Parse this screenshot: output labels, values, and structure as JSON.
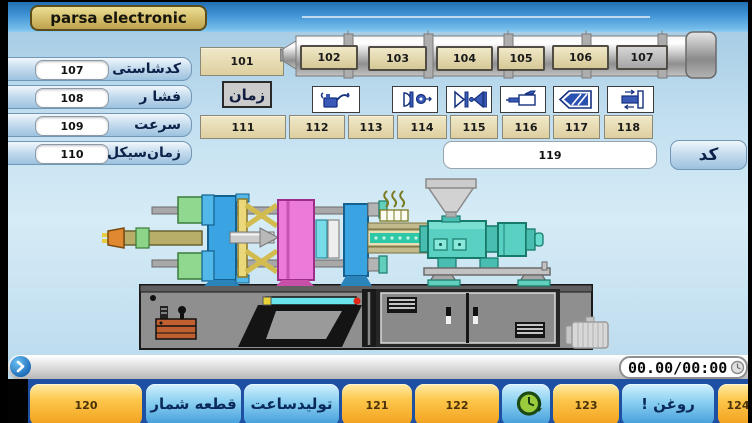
{
  "title": "parsa electronic",
  "left_panel": {
    "rows": [
      {
        "value": "107",
        "label": "کدشاستی"
      },
      {
        "value": "108",
        "label": "فشا ر"
      },
      {
        "value": "109",
        "label": "سرعت"
      },
      {
        "value": "110",
        "label": "زمان‌سیکل"
      }
    ]
  },
  "heating": {
    "time_value": "101",
    "time_label": "زمان",
    "barrel_buttons": [
      "102",
      "103",
      "104",
      "105",
      "106",
      "107"
    ]
  },
  "icon_row": {
    "icons": [
      "oil-can",
      "mold-open-eject",
      "mold-close",
      "injection-unit",
      "screw-charge",
      "carriage-move"
    ]
  },
  "process_fields": {
    "values": [
      "111",
      "112",
      "113",
      "114",
      "115",
      "116",
      "117",
      "118"
    ]
  },
  "code_row": {
    "value": "119",
    "button_label": "کد"
  },
  "status_bar": {
    "timer": "00.00/00:00"
  },
  "bottom_bar": {
    "buttons": [
      {
        "label": "120",
        "type": "orange"
      },
      {
        "label": "قطعه شمار",
        "type": "blue"
      },
      {
        "label": "تولیدساعت",
        "type": "blue"
      },
      {
        "label": "121",
        "type": "orange"
      },
      {
        "label": "122",
        "type": "orange"
      },
      {
        "label": "",
        "type": "blue-icon"
      },
      {
        "label": "123",
        "type": "orange"
      },
      {
        "label": "روغن !",
        "type": "blue"
      },
      {
        "label": "124",
        "type": "orange"
      }
    ]
  },
  "colors": {
    "titlebar_blue": "#2e7fc4",
    "badge_gold": "#d4bd6a",
    "field_tan": "#e6dcb2",
    "button_orange": "#f6ac28",
    "button_blue": "#58a8e0",
    "machine_teal": "#5ad0c2",
    "platen_pink": "#ec7ad8",
    "platen_blue": "#3aa4e2"
  }
}
